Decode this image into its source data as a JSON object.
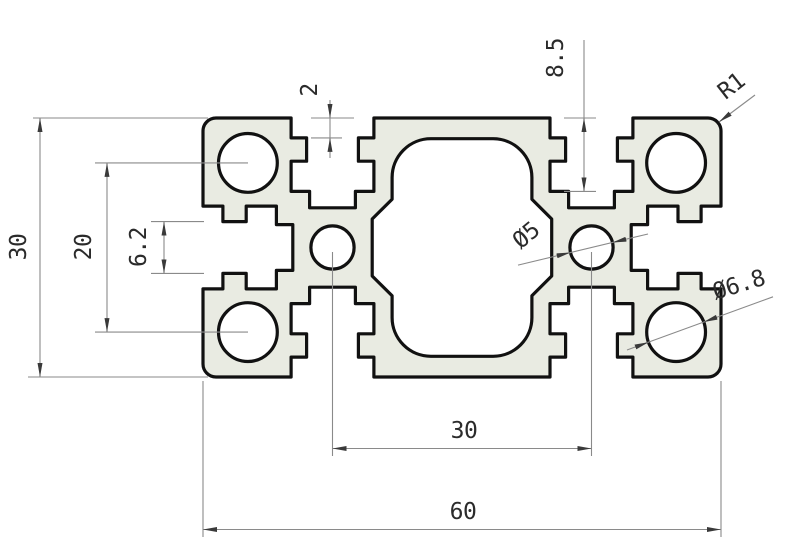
{
  "drawing": {
    "dims": {
      "height": "30",
      "hole_pitch": "20",
      "slot_opening": "6.2",
      "lip_depth": "2",
      "slot_depth": "8.5",
      "corner_radius": "R1",
      "center_hole": "Ø5",
      "center_hole_pitch": "30",
      "corner_hole": "Ø6.8",
      "width": "60"
    },
    "colors": {
      "background": "#ffffff",
      "profile_fill": "#e9ebe2",
      "outline": "#111111",
      "dim_line": "#8a8a8a",
      "dim_text": "#2b2b2b"
    }
  }
}
